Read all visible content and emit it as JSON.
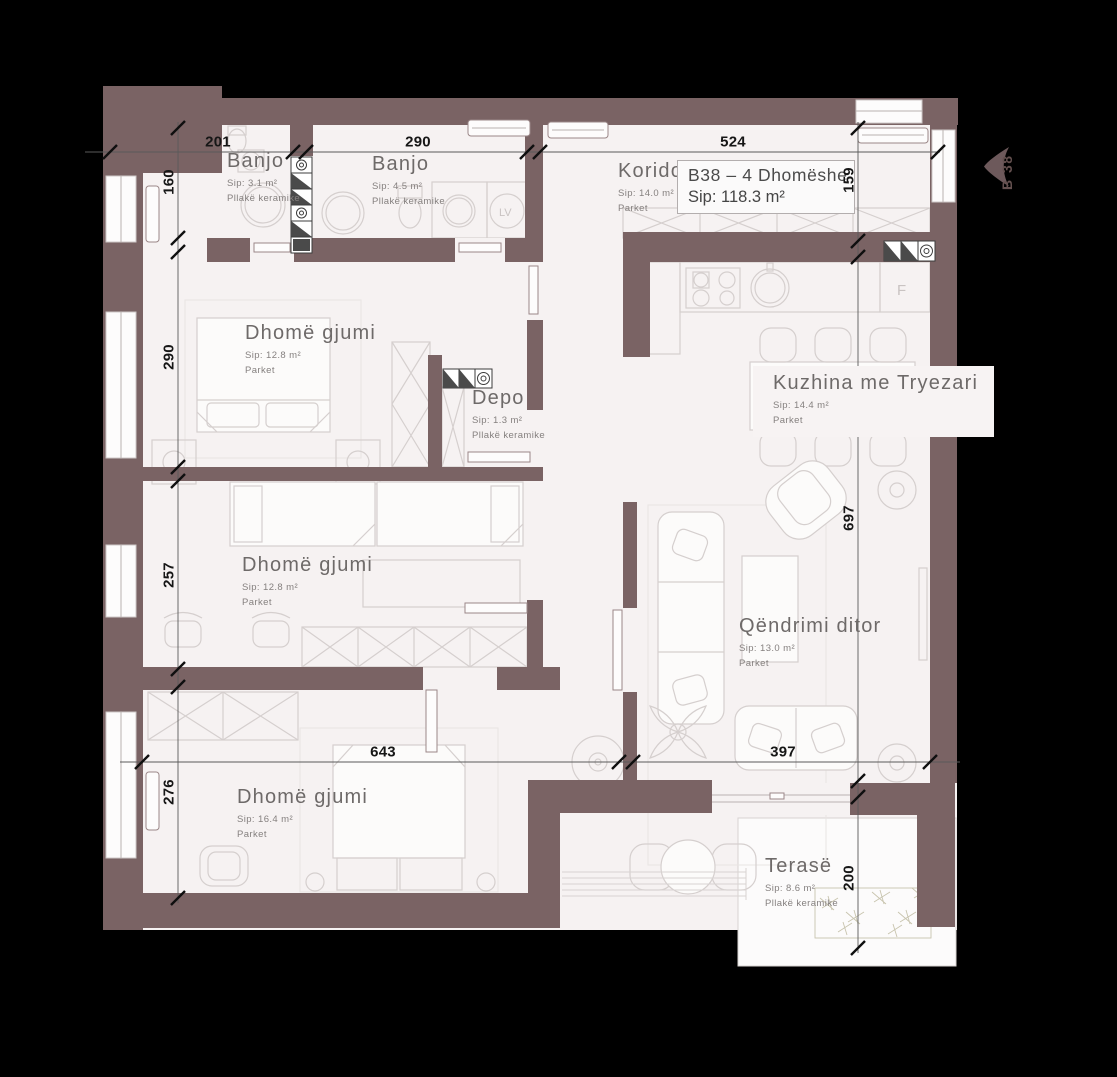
{
  "title_box": {
    "title": "B38 – 4 Dhomëshe",
    "area": "Sip: 118.3 m²"
  },
  "marker": {
    "label": "B 38"
  },
  "rooms": [
    {
      "name": "Banjo",
      "area": "Sip: 3.1 m²",
      "floor": "Pllakë keramike"
    },
    {
      "name": "Banjo",
      "area": "Sip: 4.5 m²",
      "floor": "Pllakë keramike"
    },
    {
      "name": "Koridori",
      "area": "Sip: 14.0 m²",
      "floor": "Parket"
    },
    {
      "name": "Dhomë gjumi",
      "area": "Sip: 12.8 m²",
      "floor": "Parket"
    },
    {
      "name": "Depo",
      "area": "Sip: 1.3 m²",
      "floor": "Pllakë keramike"
    },
    {
      "name": "Kuzhina me Tryezari",
      "area": "Sip: 14.4 m²",
      "floor": "Parket"
    },
    {
      "name": "Dhomë gjumi",
      "area": "Sip: 12.8 m²",
      "floor": "Parket"
    },
    {
      "name": "Qëndrimi ditor",
      "area": "Sip: 13.0 m²",
      "floor": "Parket"
    },
    {
      "name": "Dhomë gjumi",
      "area": "Sip: 16.4 m²",
      "floor": "Parket"
    },
    {
      "name": "Terasë",
      "area": "Sip: 8.6 m²",
      "floor": "Pllakë keramike"
    }
  ],
  "dimensions": {
    "top": [
      "201",
      "290",
      "524"
    ],
    "left": [
      "160",
      "290",
      "257",
      "276"
    ],
    "right": [
      "159",
      "697",
      "200"
    ],
    "bottom": [
      "643",
      "397"
    ]
  },
  "appliances": {
    "fridge": "F",
    "washing_machine": "LV"
  },
  "colors": {
    "wall": "#7a6364",
    "floor": "#f6f2f2",
    "background": "#000000"
  }
}
